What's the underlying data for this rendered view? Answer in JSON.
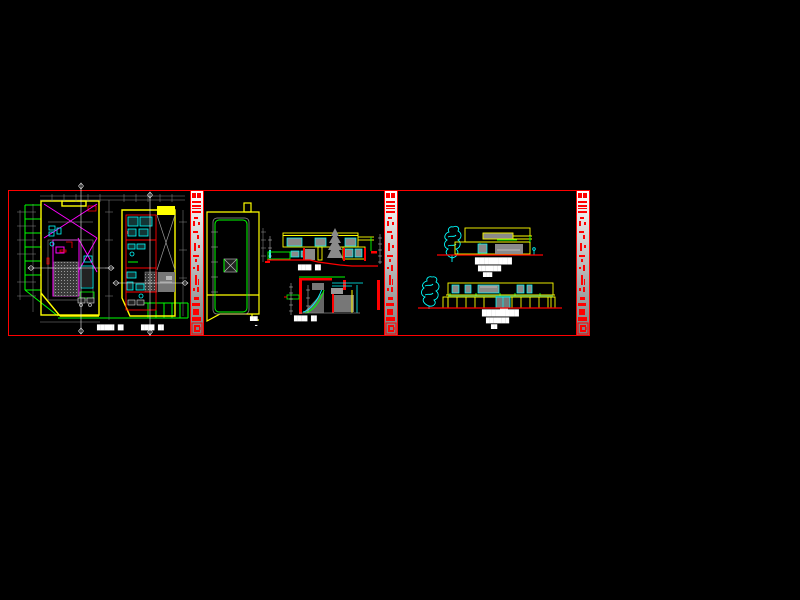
{
  "app": {
    "type": "cad-drawing-viewport",
    "background": "#000000",
    "sheet_count": 3
  },
  "palette": {
    "red": "#ff0000",
    "yellow": "#ffff00",
    "green": "#00ff00",
    "cyan": "#00ffff",
    "magenta": "#ff00ff",
    "gray": "#9a9a9a",
    "darkgray": "#777777",
    "white": "#ffffff",
    "strip_top": "#ffffff",
    "strip_bottom": "#7e7e7e"
  },
  "sheets": [
    {
      "name": "floor-plans",
      "description": "two floor plans with site boundary"
    },
    {
      "name": "roof-plan-and-sections",
      "description": "roof plan and two building sections"
    },
    {
      "name": "elevations",
      "description": "two building elevations with trees"
    }
  ],
  "labels": {
    "plan_a": "████▌ █▌",
    "plan_b": "███▌ █▌",
    "roof": "██▌",
    "roof_scale": "▂",
    "section_1": "███▌ █▌",
    "section_2": "███▌ █▌",
    "elev1_l1": "████████",
    "elev1_l2": "██████",
    "elev1_l3": "███",
    "elev2_l1": "████████",
    "elev2_l2": "██████",
    "elev2_l3": "██"
  }
}
